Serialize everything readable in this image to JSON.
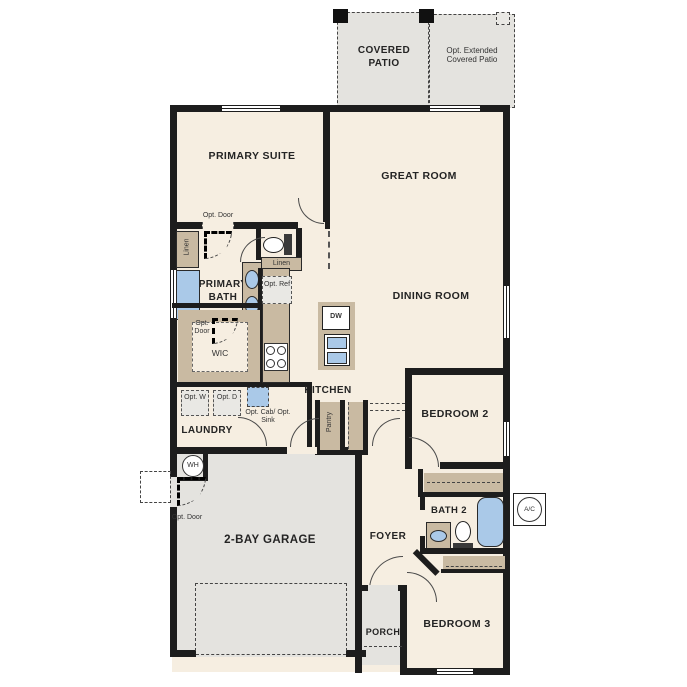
{
  "colors": {
    "wall": "#1d1d1d",
    "floor": "#f6eee1",
    "patio_garage_gray": "#e4e3df",
    "cabinet_tan": "#c9baa2",
    "fixture_blue": "#aac9e8",
    "optional_dashed_fill": "#e9e8e4"
  },
  "rooms": {
    "covered_patio": "COVERED PATIO",
    "opt_extended_patio": "Opt. Extended Covered Patio",
    "primary_suite": "PRIMARY SUITE",
    "great_room": "GREAT ROOM",
    "dining_room": "DINING ROOM",
    "primary_bath": "PRIMARY BATH",
    "wic": "WIC",
    "kitchen": "KITCHEN",
    "laundry": "LAUNDRY",
    "bedroom2": "BEDROOM 2",
    "garage": "2-BAY GARAGE",
    "foyer": "FOYER",
    "bath2": "BATH 2",
    "bedroom3": "BEDROOM 3",
    "porch": "PORCH"
  },
  "annotations": {
    "opt_door": "Opt. Door",
    "linen": "Linen",
    "opt_ref": "Opt. Ref",
    "opt_w": "Opt. W",
    "opt_d": "Opt. D",
    "opt_cab_sink": "Opt. Cab/ Opt. Sink",
    "pantry": "Pantry",
    "wh": "WH",
    "ac": "A/C",
    "dw": "DW"
  }
}
